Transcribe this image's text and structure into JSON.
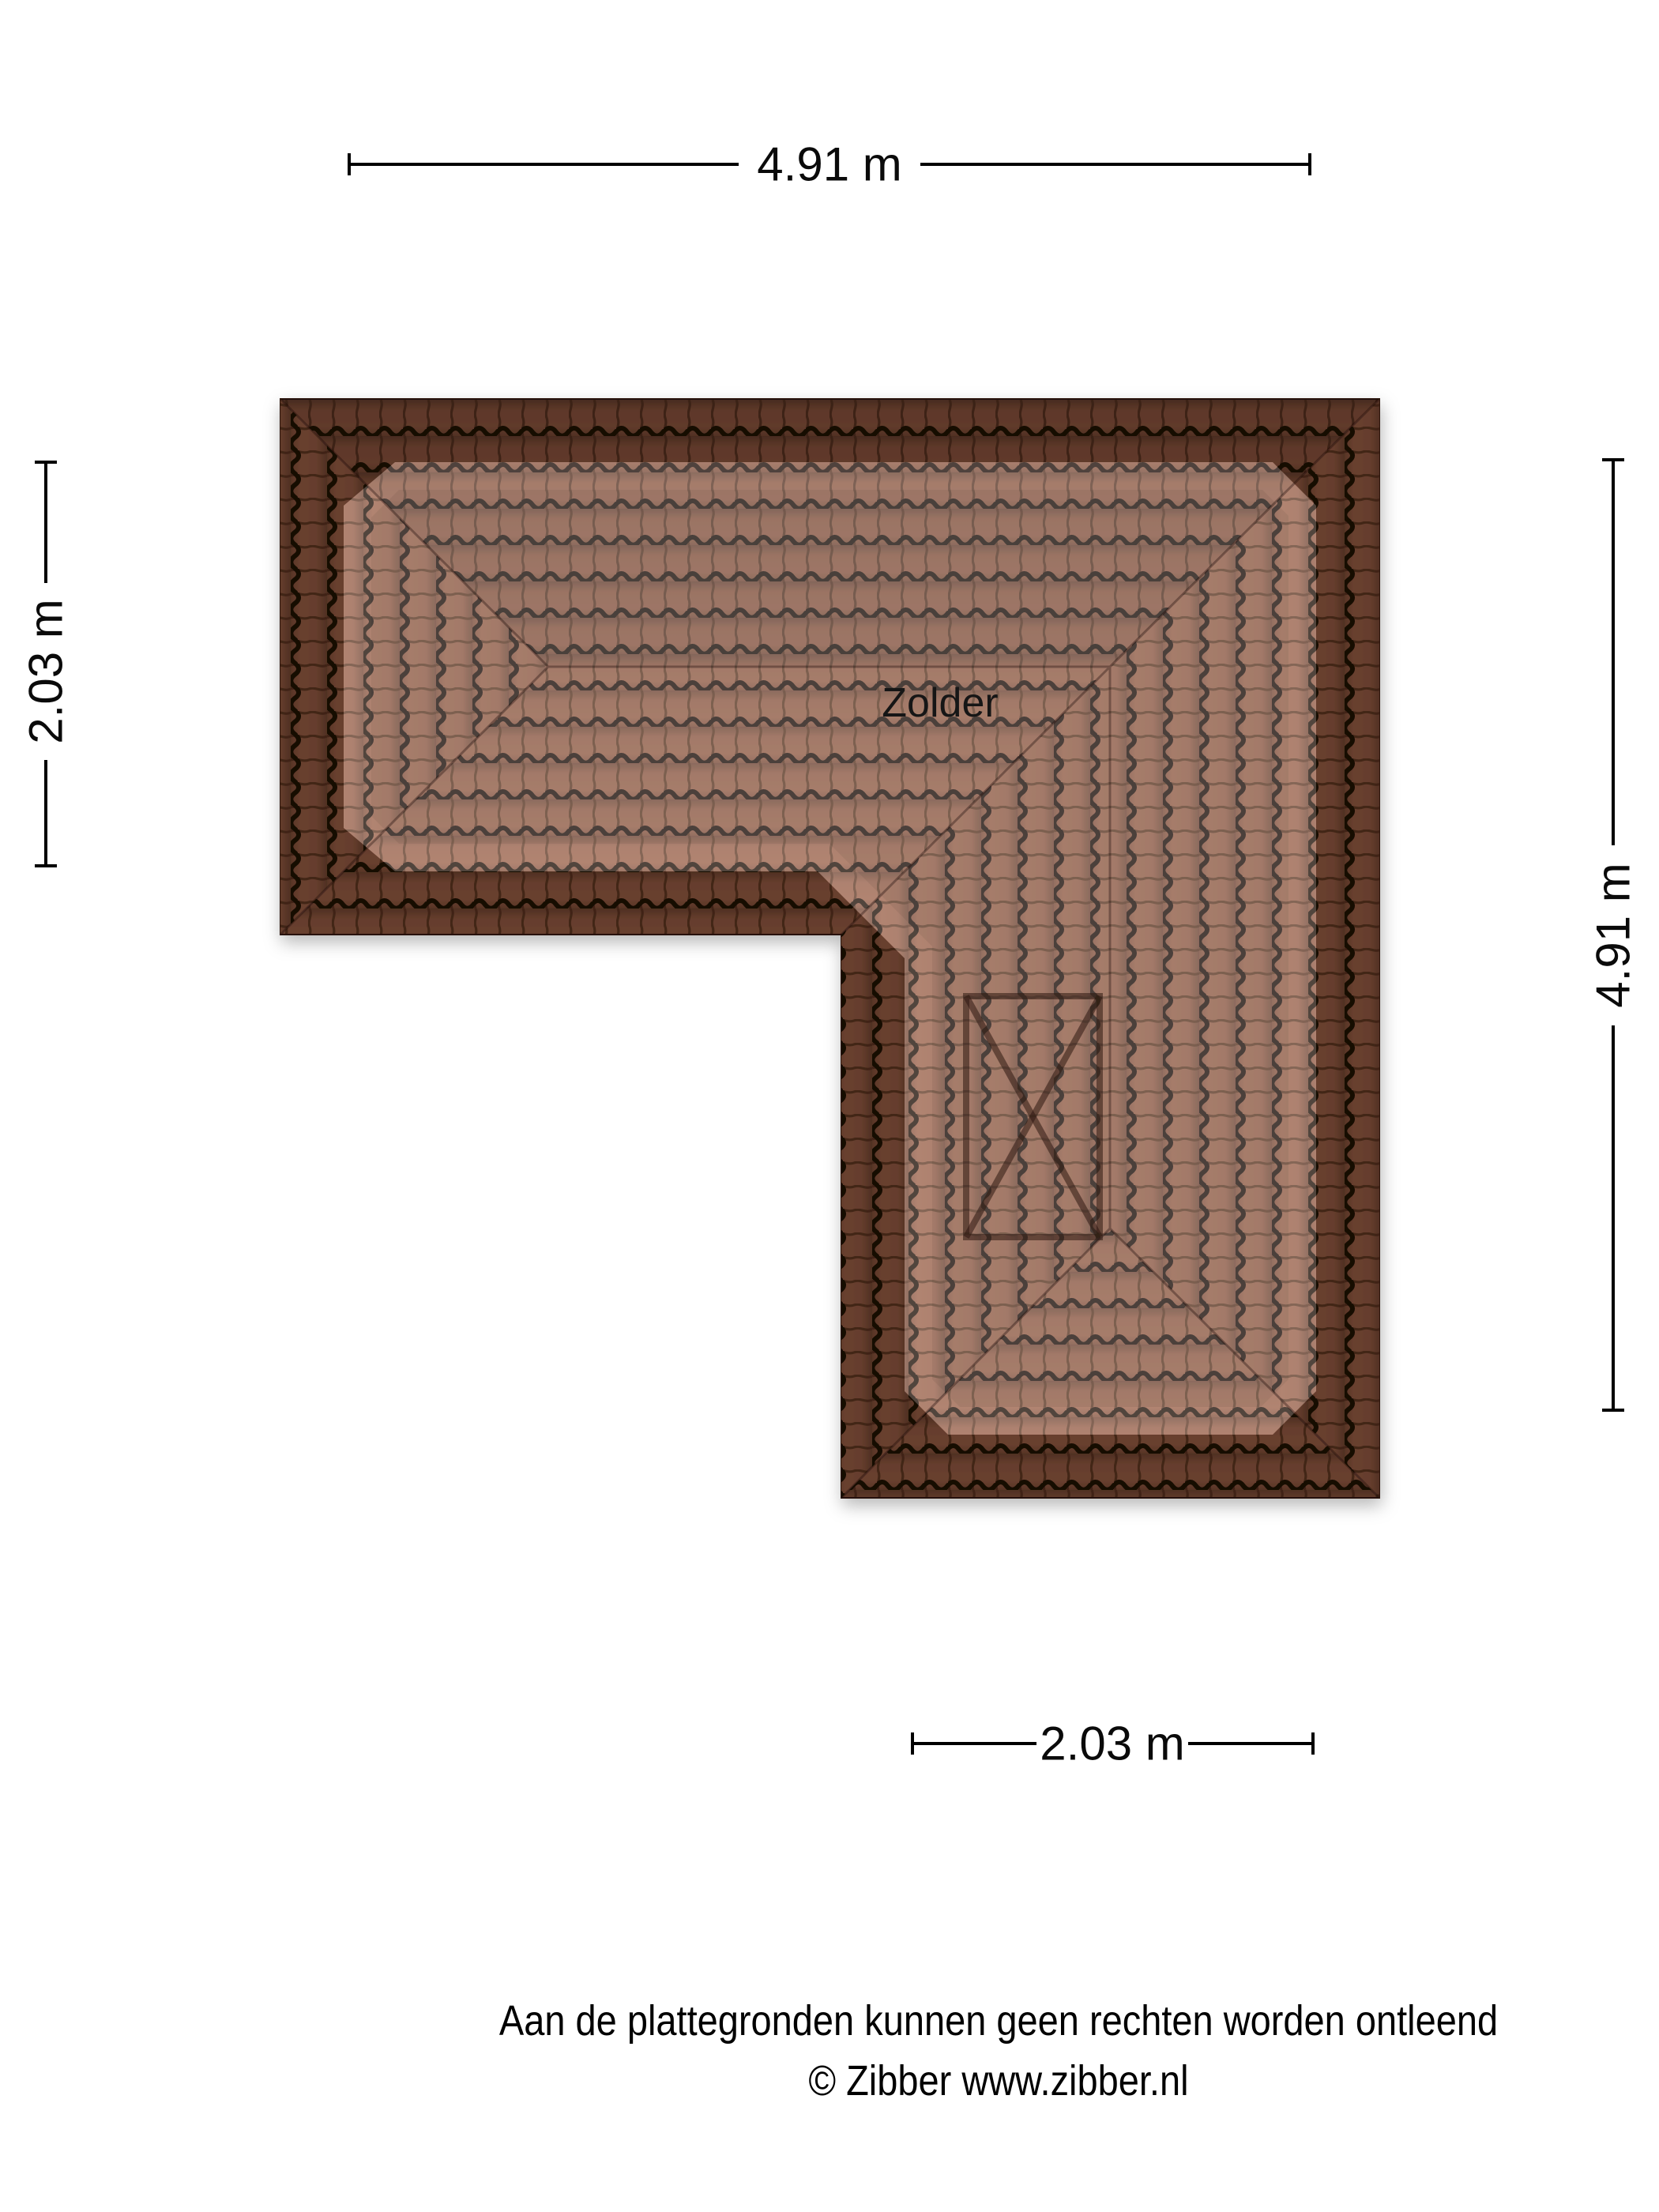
{
  "plan": {
    "room_label": "Zolder",
    "dimensions": {
      "top": "4.91 m",
      "left": "2.03 m",
      "right": "4.91 m",
      "bottom": "2.03 m"
    },
    "colors": {
      "tile_base": "#9a5f47",
      "tile_gap_line": "#1d0d05",
      "tile_rib_line": "#57311f",
      "outer_shade": "rgba(10,2,0,0.34)",
      "inner_highlight": "rgba(255,255,255,0.23)",
      "window_line": "#2e1810",
      "dimension_line": "#000000"
    }
  },
  "footer": {
    "line1": "Aan de plattegronden kunnen geen rechten worden ontleend",
    "line2": "© Zibber www.zibber.nl"
  }
}
